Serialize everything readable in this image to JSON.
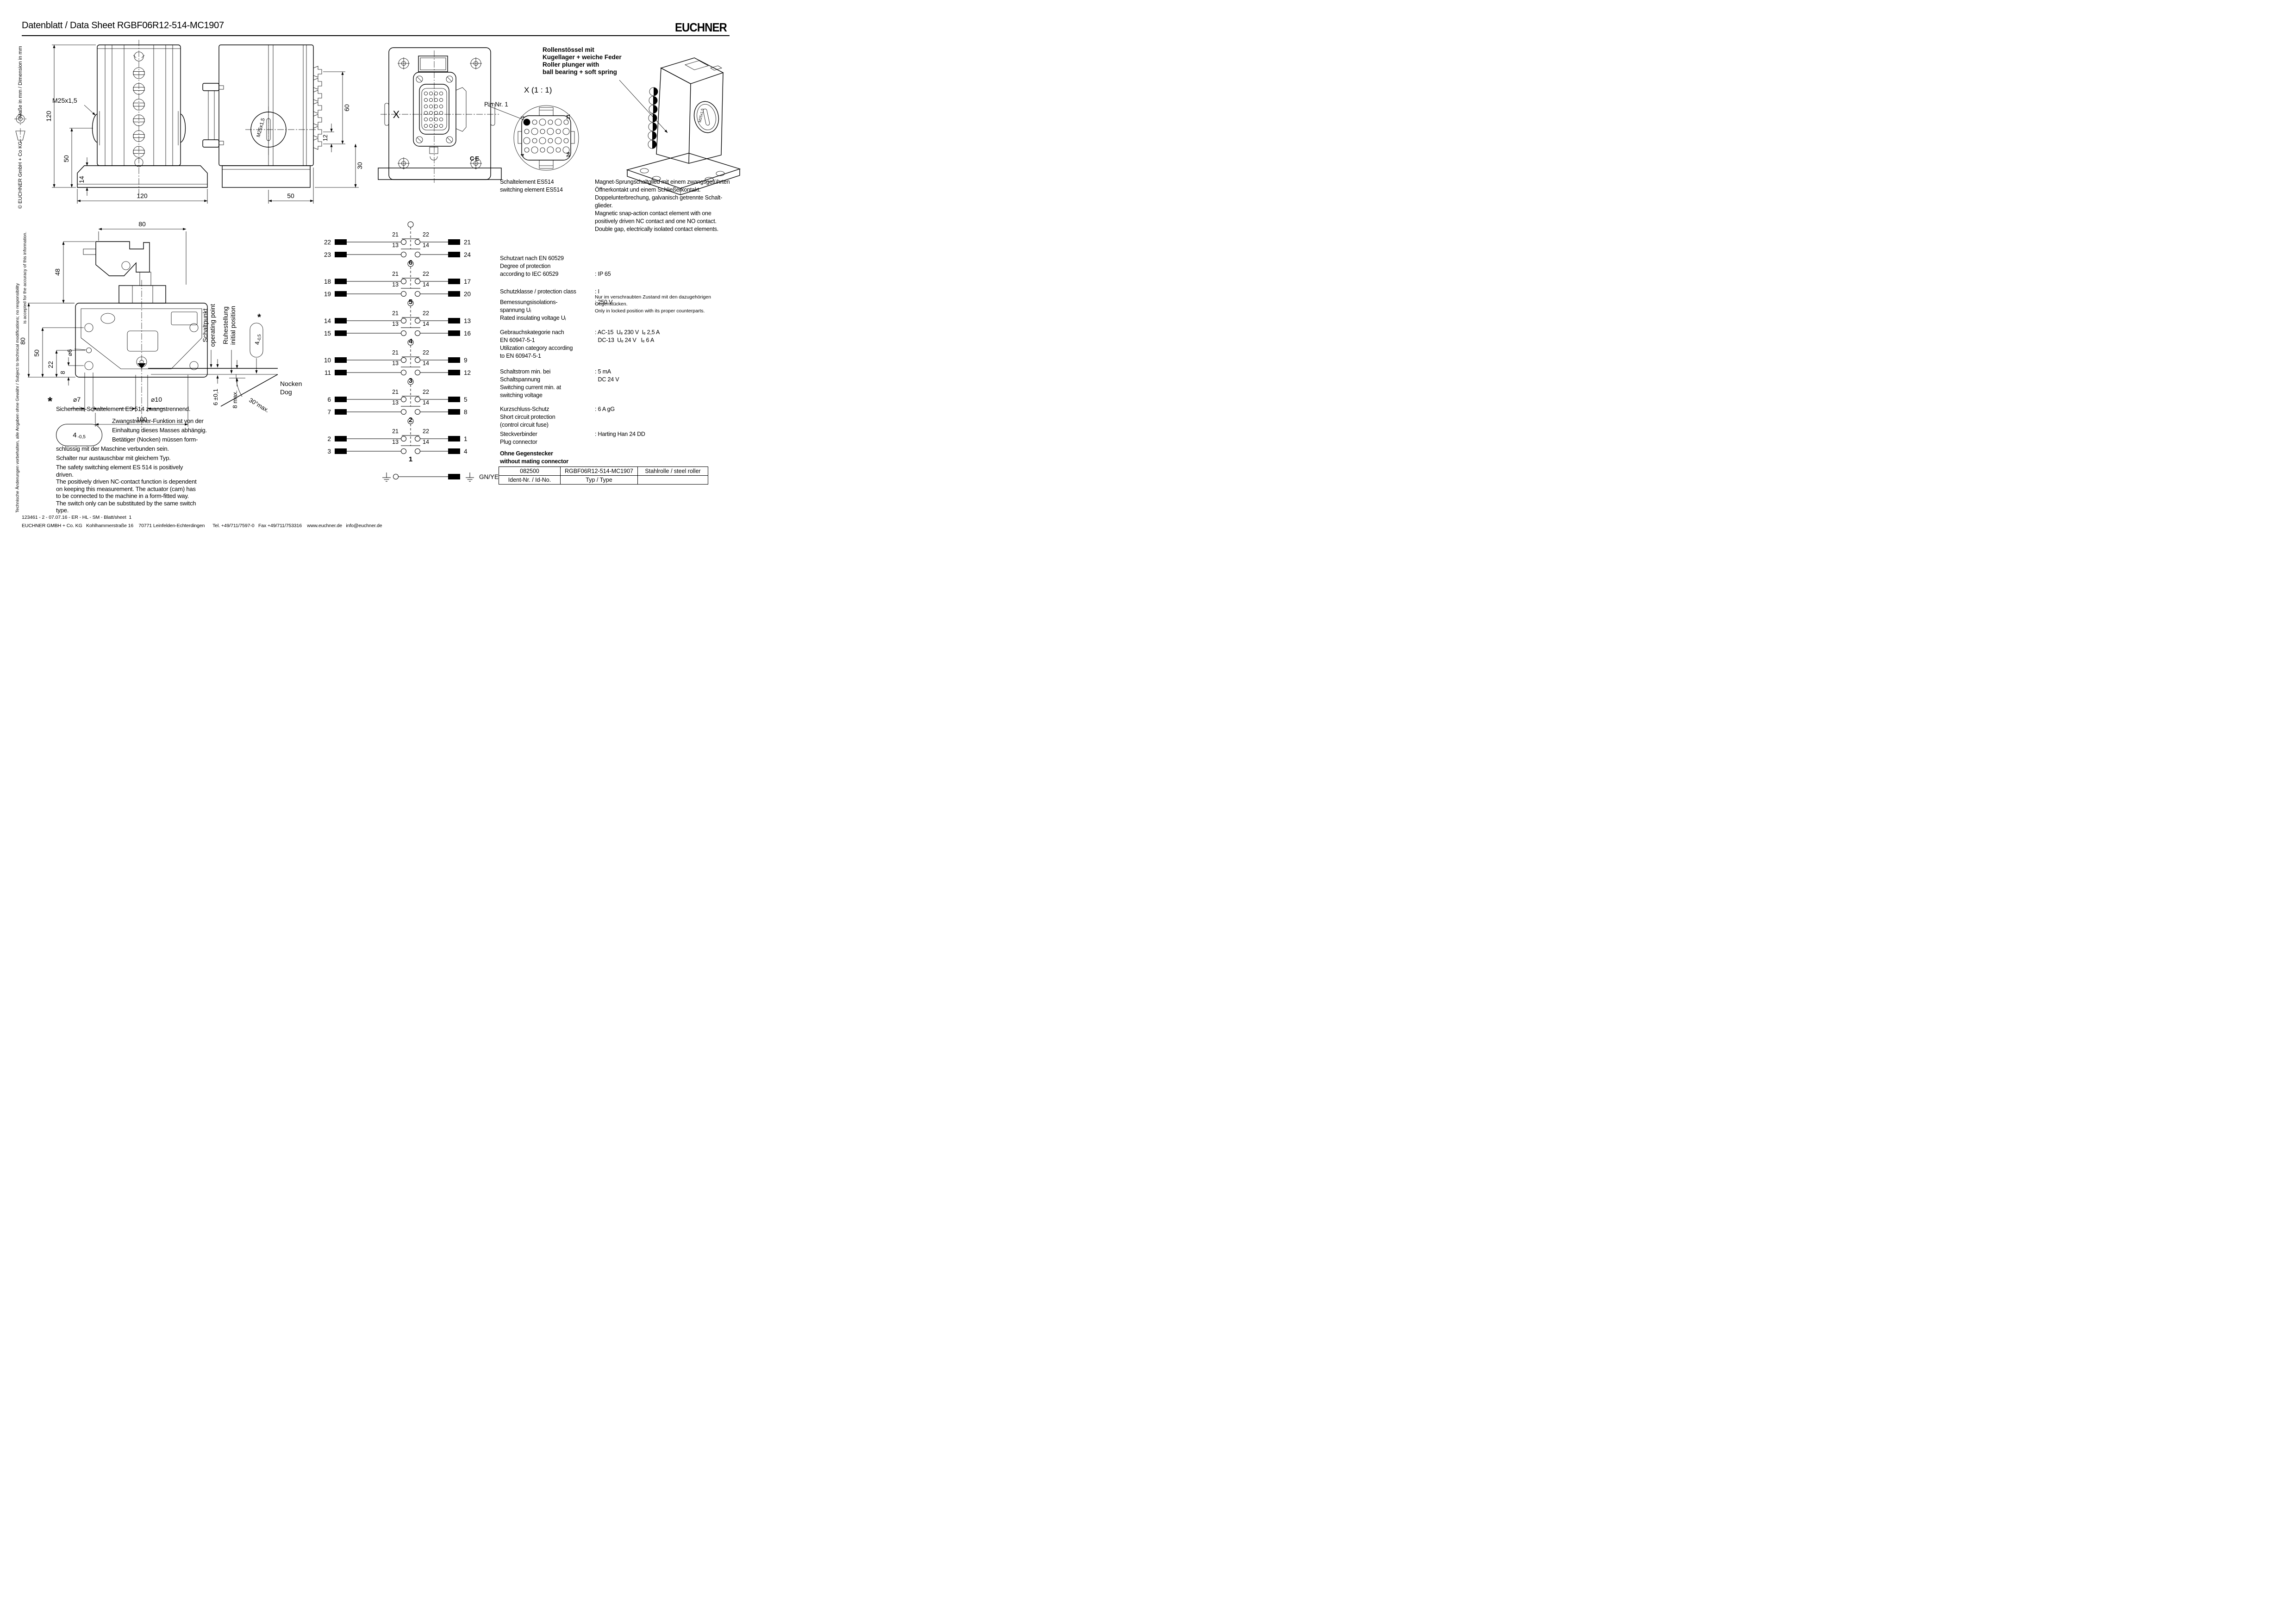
{
  "header": {
    "doc_label": "Datenblatt / Data Sheet",
    "part_number": "RGBF06R12-514-MC1907",
    "brand": "EUCHNER"
  },
  "sidebar": {
    "dimension_note": "Maße in mm / Dimension in mm",
    "copyright": "© EUCHNER GmbH + Co KG",
    "disclaimer_line1": "Technische Änderungen vorbehalten, alle Angaben ohne Gewähr / Subject to technical modifications;  no responsibility",
    "disclaimer_line2": "is accepted for the accuracy of this information."
  },
  "front_view": {
    "thread_label": "M25x1,5",
    "dim_height": "120",
    "dim_center_to_bottom": "50",
    "dim_flange": "14",
    "dim_width": "120"
  },
  "side_view": {
    "thread_label": "M25x1,5",
    "dim_depth": "50",
    "dim_fin_span": "60",
    "dim_fin_pitch": "12",
    "dim_bottom": "30"
  },
  "back_view": {
    "section_label": "X",
    "ce_mark": "CE"
  },
  "detail_view": {
    "title": "X  (1 : 1)",
    "pin_label": "Pin Nr. 1",
    "corner_pins": [
      "1",
      "21",
      "4",
      "24"
    ]
  },
  "iso_view": {
    "thread_label": "M25x1,5",
    "callout_lines": [
      "Rollenstössel mit",
      "Kugellager + weiche Feder",
      "Roller plunger with",
      "ball bearing + soft spring"
    ]
  },
  "bottom_view": {
    "dim_top_width": "80",
    "dim_cam_height": "48",
    "dim_body_height": "80",
    "dim_hole_to_bottom": "50",
    "dim_mid": "22",
    "dim_small": "8",
    "dia_6": "⌀6",
    "dia_7": "⌀7",
    "dia_10": "⌀10",
    "dim_hole_span": "100",
    "dim_travel": "6 ±0,1",
    "dim_max_travel": "8 max.",
    "dim_angle": "30°max.",
    "operating_de": "Schaltpunkt",
    "operating_en": "operating point",
    "initial_de": "Ruhestellung",
    "initial_en": "initial position",
    "cam_de": "Nocken",
    "cam_en": "Dog",
    "gap_value": "4",
    "gap_tol": "-0,5",
    "asterisk": "*"
  },
  "circuit": {
    "nc_left": "21",
    "nc_right": "22",
    "no_left": "13",
    "no_right": "14",
    "groups": [
      {
        "number": "6",
        "left": [
          "22",
          "23"
        ],
        "right": [
          "21",
          "24"
        ]
      },
      {
        "number": "5",
        "left": [
          "18",
          "19"
        ],
        "right": [
          "17",
          "20"
        ]
      },
      {
        "number": "4",
        "left": [
          "14",
          "15"
        ],
        "right": [
          "13",
          "16"
        ]
      },
      {
        "number": "3",
        "left": [
          "10",
          "11"
        ],
        "right": [
          "9",
          "12"
        ]
      },
      {
        "number": "2",
        "left": [
          "6",
          "7"
        ],
        "right": [
          "5",
          "8"
        ]
      },
      {
        "number": "1",
        "left": [
          "2",
          "3"
        ],
        "right": [
          "1",
          "4"
        ]
      }
    ],
    "ground_label": "GN/YE"
  },
  "specs": {
    "rows": [
      {
        "label_lines": [
          "Schaltelement ES514",
          "switching element ES514"
        ],
        "value_lines": [
          "Magnet-Sprungschaltglied mit einem zwangsgeführten",
          "Öffnerkontakt und einem Schließerkontakt.",
          "Doppelunterbrechung, galvanisch getrennte Schalt-",
          "glieder.",
          "Magnetic snap-action contact element with one",
          "positively driven NC contact and one NO contact.",
          "Double gap, electrically isolated contact elements."
        ]
      },
      {
        "label_lines": [
          "Schutzart nach EN 60529",
          "Degree of protection",
          "according to IEC 60529"
        ],
        "value_main": ": IP 65",
        "note_lines": [
          "Nur im verschraubten Zustand mit den dazugehörigen",
          "Gegenstücken.",
          "Only in locked position with its proper counterparts."
        ]
      },
      {
        "label_lines": [
          "Schutzklasse / protection class"
        ],
        "value_lines": [
          ": I"
        ]
      },
      {
        "label_lines": [
          "Bemessungsisolations-",
          "spannung Uᵢ",
          "Rated insulating voltage Uᵢ"
        ],
        "value_lines": [
          ": 250 V"
        ]
      },
      {
        "label_lines": [
          "Gebrauchskategorie nach",
          "EN 60947-5-1",
          "Utilization category according",
          "to EN 60947-5-1"
        ],
        "value_lines": [
          ": AC-15  Uₑ 230 V  Iₑ 2,5 A",
          "  DC-13  Uₑ 24 V   Iₑ 6 A"
        ]
      },
      {
        "label_lines": [
          "Schaltstrom  min. bei",
          "Schaltspannung",
          "Switching current min. at",
          "switching voltage"
        ],
        "value_lines": [
          ": 5 mA",
          "  DC 24 V"
        ]
      },
      {
        "label_lines": [
          "Kurzschluss-Schutz",
          "Short circuit protection",
          "(control circuit fuse)"
        ],
        "value_lines": [
          ": 6 A gG"
        ]
      },
      {
        "label_lines": [
          "Steckverbinder",
          "Plug connector"
        ],
        "value_lines": [
          ": Harting Han 24 DD"
        ]
      },
      {
        "label_lines": [
          "Ohne Gegenstecker",
          "without mating connector"
        ],
        "value_lines": []
      }
    ]
  },
  "id_table": {
    "id_value": "082500",
    "type_value": "RGBF06R12-514-MC1907",
    "roller_value": "Stahlrolle / steel roller",
    "id_label": "Ident-Nr. / Id-No.",
    "type_label": "Typ / Type"
  },
  "footnote": {
    "asterisk": "*",
    "line1": "Sicherheits-Schaltelement ES 514 zwangstrennend.",
    "gap_value": "4",
    "gap_tol": "-0,5",
    "indented_lines": [
      "Zwangstrenner-Funktion ist von der",
      "Einhaltung dieses Masses abhängig.",
      "Betätiger (Nocken) müssen form-"
    ],
    "full_lines": [
      "schlüssig mit der Maschine verbunden sein.",
      "Schalter nur austauschbar mit gleichem Typ."
    ],
    "english_lines": [
      "The safety switching element ES 514 is positively",
      "driven.",
      "The positively driven NC-contact function is dependent",
      "on keeping this measurement. The actuator (cam) has",
      "to be connected to the machine in a form-fitted way.",
      "The switch only can be substituted by the same switch",
      "type."
    ]
  },
  "footer": {
    "line1": "123461 - 2 - 07.07.16 - ER - HL - SM - Blatt/sheet  1",
    "line2": "EUCHNER GMBH + Co. KG   Kohlhammerstraße 16    70771 Leinfelden-Echterdingen      Tel. +49/711/7597-0   Fax +49/711/753316    www.euchner.de   info@euchner.de"
  }
}
